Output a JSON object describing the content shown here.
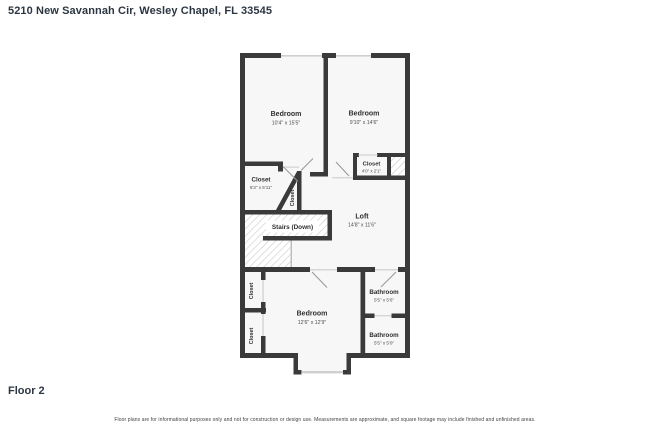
{
  "header": {
    "title": "5210 New Savannah Cir, Wesley Chapel, FL 33545"
  },
  "footer": {
    "floor_label": "Floor 2",
    "disclaimer": "Floor plans are for informational purposes only and not for construction or design use. Measurements are approximate, and square footage may include finished and unfinished areas."
  },
  "colors": {
    "wall": "#3a3a3a",
    "floor": "#f7f7f7",
    "window": "#cfcfcf",
    "hatch": "#c9c9c9",
    "text": "#2f2f2f",
    "title_text": "#2c3642"
  },
  "plan": {
    "rooms": {
      "bedroom_tl": {
        "name": "Bedroom",
        "dims": "10'4\" x 15'5\""
      },
      "bedroom_tr": {
        "name": "Bedroom",
        "dims": "9'10\" x 14'6\""
      },
      "closet_tr": {
        "name": "Closet",
        "dims": "4'0\" x 2'1\""
      },
      "closet_mid": {
        "name": "Closet",
        "dims": "6'3\" x 5'11\""
      },
      "closet_angled": {
        "name": "Closet"
      },
      "stairs": {
        "name": "Stairs (Down)"
      },
      "loft": {
        "name": "Loft",
        "dims": "14'8\" x 11'6\""
      },
      "closet_b1": {
        "name": "Closet"
      },
      "closet_b2": {
        "name": "Closet"
      },
      "bedroom_b": {
        "name": "Bedroom",
        "dims": "12'6\" x 12'9\""
      },
      "bathroom_1": {
        "name": "Bathroom",
        "dims": "5'5\" x 5'6\""
      },
      "bathroom_2": {
        "name": "Bathroom",
        "dims": "5'5\" x 5'0\""
      }
    }
  }
}
